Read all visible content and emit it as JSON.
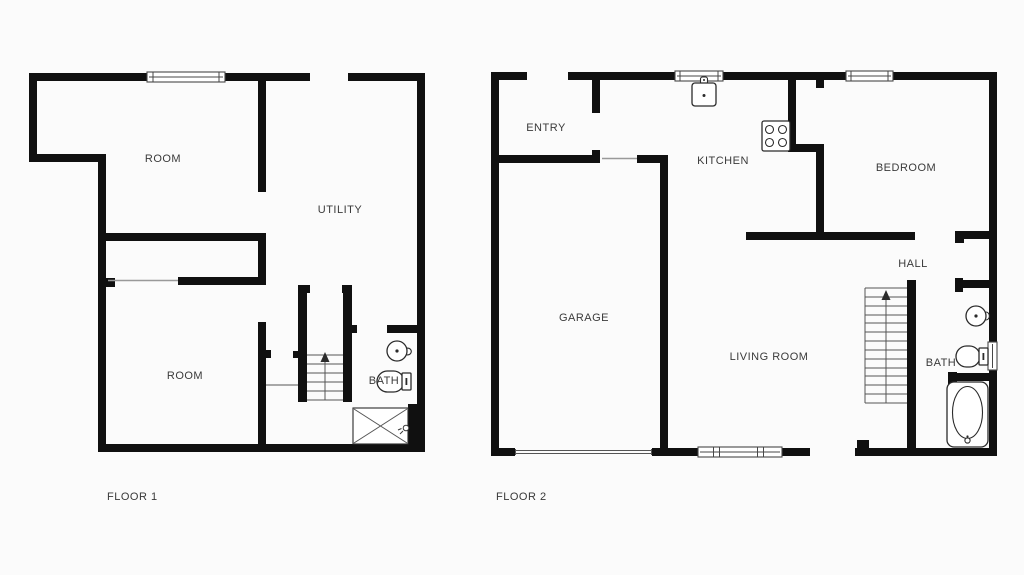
{
  "meta": {
    "type": "floor-plan",
    "floor_count": 2,
    "background_color": "#fbfbfb",
    "wall_color": "#101010",
    "label_color": "#3a3a3a"
  },
  "floor1": {
    "name": "FLOOR 1",
    "rooms": {
      "room_upper": "ROOM",
      "utility": "UTILITY",
      "room_lower": "ROOM",
      "bath": "BATH"
    }
  },
  "floor2": {
    "name": "FLOOR 2",
    "rooms": {
      "entry": "ENTRY",
      "kitchen": "KITCHEN",
      "bedroom": "BEDROOM",
      "hall": "HALL",
      "garage": "GARAGE",
      "living_room": "LIVING ROOM",
      "bath": "BATH"
    }
  },
  "icons": [
    "stairs-up-icon",
    "toilet-icon",
    "round-sink-icon",
    "shower-icon",
    "bathtub-icon",
    "stove-icon",
    "kitchen-sink-icon",
    "window-symbol",
    "garage-door-symbol"
  ]
}
